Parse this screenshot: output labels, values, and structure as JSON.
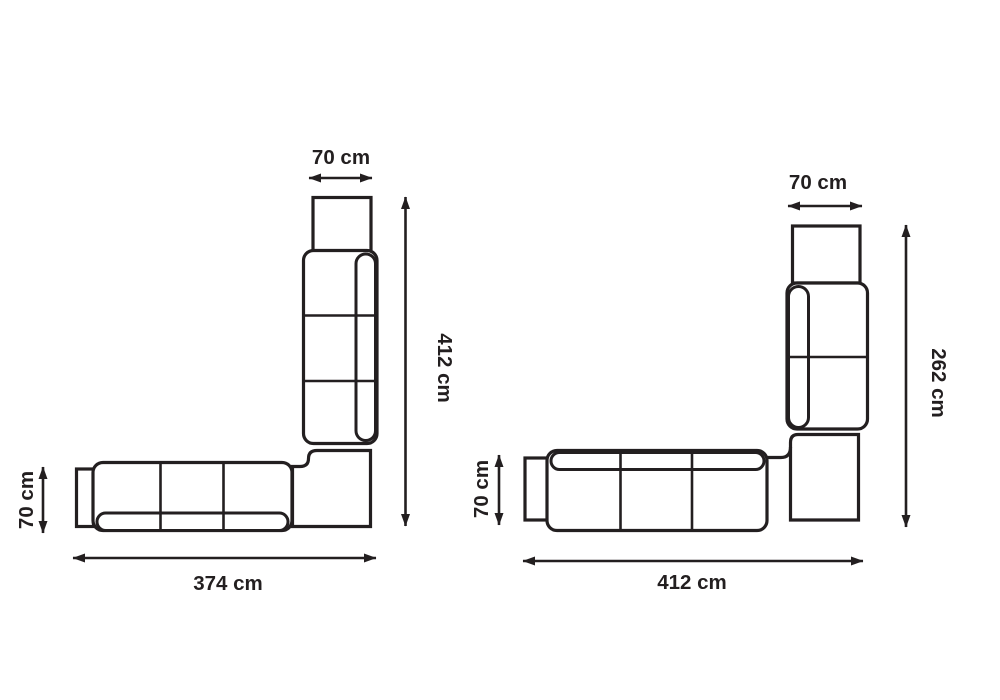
{
  "colors": {
    "line": "#231f20",
    "background": "#ffffff"
  },
  "diagrams": {
    "left": {
      "dims": {
        "top": "70 cm",
        "side": "412 cm",
        "left": "70 cm",
        "bottom": "374 cm"
      }
    },
    "right": {
      "dims": {
        "top": "70 cm",
        "side": "262 cm",
        "left": "70 cm",
        "bottom": "412 cm"
      }
    }
  }
}
